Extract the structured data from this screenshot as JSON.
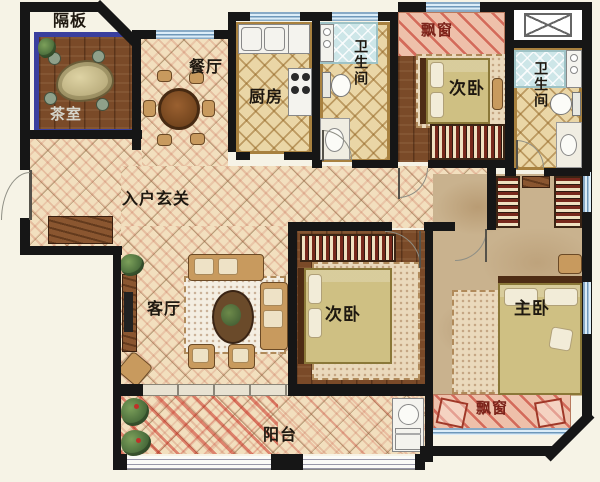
{
  "plan": {
    "labels": {
      "partition": "隔板",
      "tea_room": "茶室",
      "dining_room": "餐厅",
      "kitchen": "厨房",
      "bathroom_top": "卫生间",
      "bathroom_right": "卫生间",
      "bay_window_top": "飘窗",
      "bay_window_bottom": "飘窗",
      "bedroom_top": "次卧",
      "bedroom_middle": "次卧",
      "master_bedroom": "主卧",
      "entrance_hall": "入户玄关",
      "living_room": "客厅",
      "balcony": "阳台"
    },
    "colors": {
      "wall": "#161616",
      "background": "#f6f3e6",
      "tile_base": "#f2dfbe",
      "hatch_red": "#c23c2e",
      "wood_floor": "#7a4a28",
      "kitchen_bath_floor": "#ead6a6",
      "shower_tile": "#cde6e8",
      "master_carpet": "#c9b28e",
      "bay_window_pink": "#eec0aa",
      "window_glass": "#b9d2e6",
      "tea_room_frame": "#3a3f9e",
      "bed_cover": "#cfc083",
      "furniture_tan": "#c89a5e"
    }
  }
}
